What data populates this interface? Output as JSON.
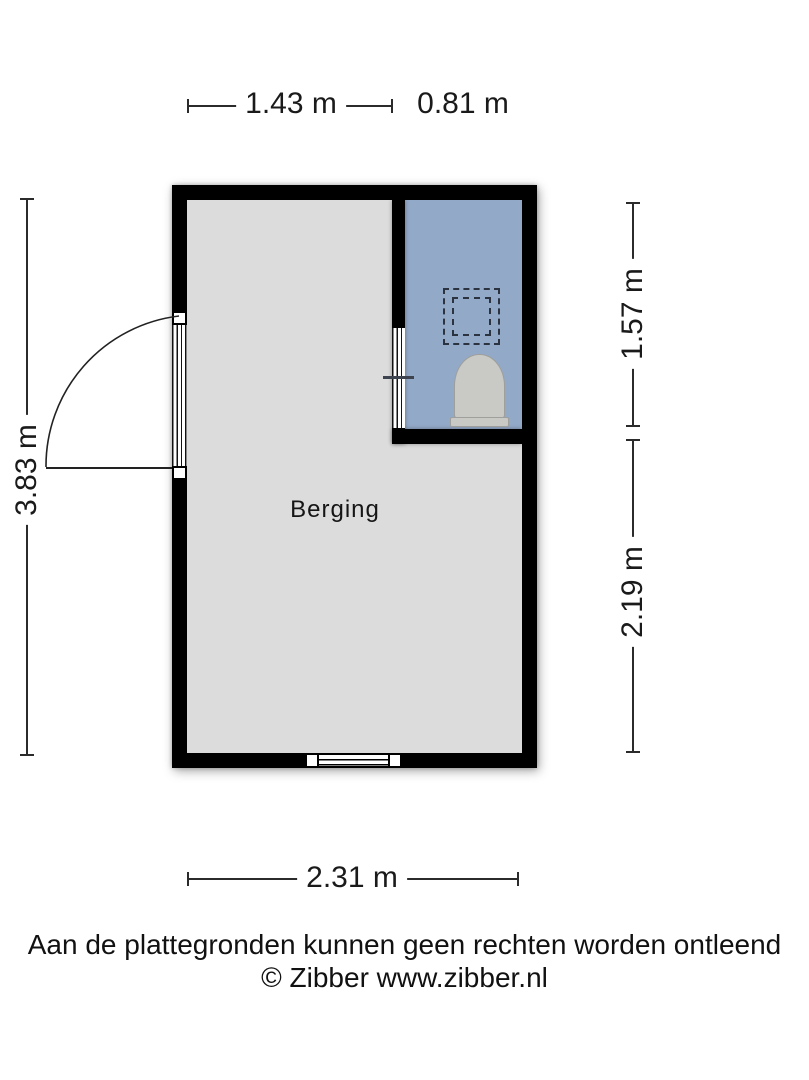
{
  "plan": {
    "room_label": "Berging",
    "areas": [
      {
        "name": "berging",
        "floor_color": "#dcdcdc"
      },
      {
        "name": "bathroom",
        "floor_color": "#93a9c8"
      }
    ],
    "icons": [
      "toilet-icon",
      "skylight-dashed-icon",
      "door-swing-arc-icon",
      "window-icon",
      "entry-door-icon",
      "bathroom-door-icon"
    ]
  },
  "dimensions": {
    "top_width_left": "1.43 m",
    "top_width_right": "0.81 m",
    "left_height": "3.83 m",
    "right_height_upper": "1.57 m",
    "right_height_lower": "2.19 m",
    "bottom_width": "2.31 m"
  },
  "footer": {
    "disclaimer": "Aan de plattegronden kunnen geen rechten worden ontleend",
    "copyright": "© Zibber www.zibber.nl"
  },
  "colors": {
    "wall": "#000000",
    "berging_floor": "#dcdcdc",
    "bathroom_floor": "#93a9c8",
    "dimension_line": "#2b2b2b",
    "text": "#111111"
  }
}
